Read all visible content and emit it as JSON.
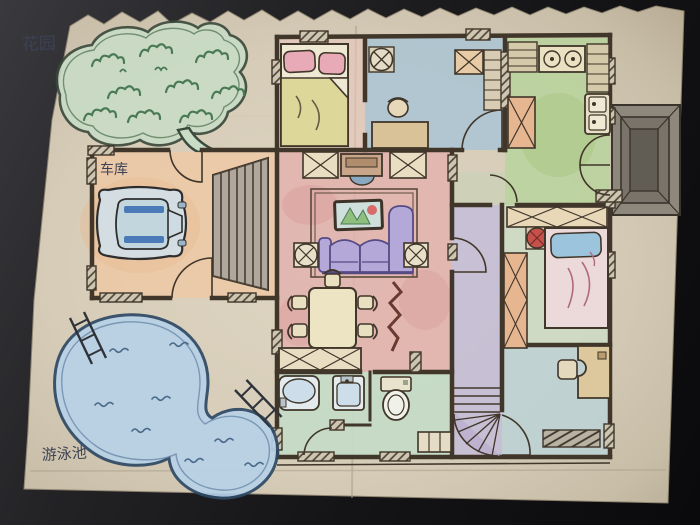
{
  "photo": {
    "background_color": "#141416",
    "paper_color": "#d8cfbc",
    "description_labels_language": "zh"
  },
  "labels": {
    "garden": "花园",
    "garage": "车库",
    "pool": "游泳池"
  },
  "palette": {
    "wall_ink": "#40362a",
    "living_room_floor": "#e2b0ac",
    "study_floor": "#aac4d4",
    "kitchen_floor": "#b9d39c",
    "bedroom_floor": "#ccdcc6",
    "bathroom_floor": "#c4dbc6",
    "hallway_floor": "#c3bbda",
    "garage_floor": "#ecc9a6",
    "bottom_room_floor": "#bcd2d6",
    "pool_water": "#b8d2e8",
    "garden_green": "#c9dcc6",
    "sofa_purple": "#b4a8d8",
    "car_body": "#d3dde2",
    "porch_gray": "#8d877c"
  },
  "objects": [
    "garden-icon",
    "garage-car-icon",
    "swimming-pool-icon",
    "ladder-icon",
    "bed-icon",
    "pillow-icon",
    "wardrobe-icon",
    "ceiling-fan-icon",
    "sofa-icon",
    "tv-cabinet-icon",
    "aquarium-picture-icon",
    "side-table-icon",
    "dining-table-icon",
    "chair-icon",
    "zigzag-decor-icon",
    "stove-icon",
    "kitchen-sink-icon",
    "fridge-shelf-icon",
    "bathtub-icon",
    "washbasin-icon",
    "toilet-icon",
    "staircase-icon",
    "winder-stairs-icon",
    "desk-icon",
    "entry-steps-icon"
  ]
}
